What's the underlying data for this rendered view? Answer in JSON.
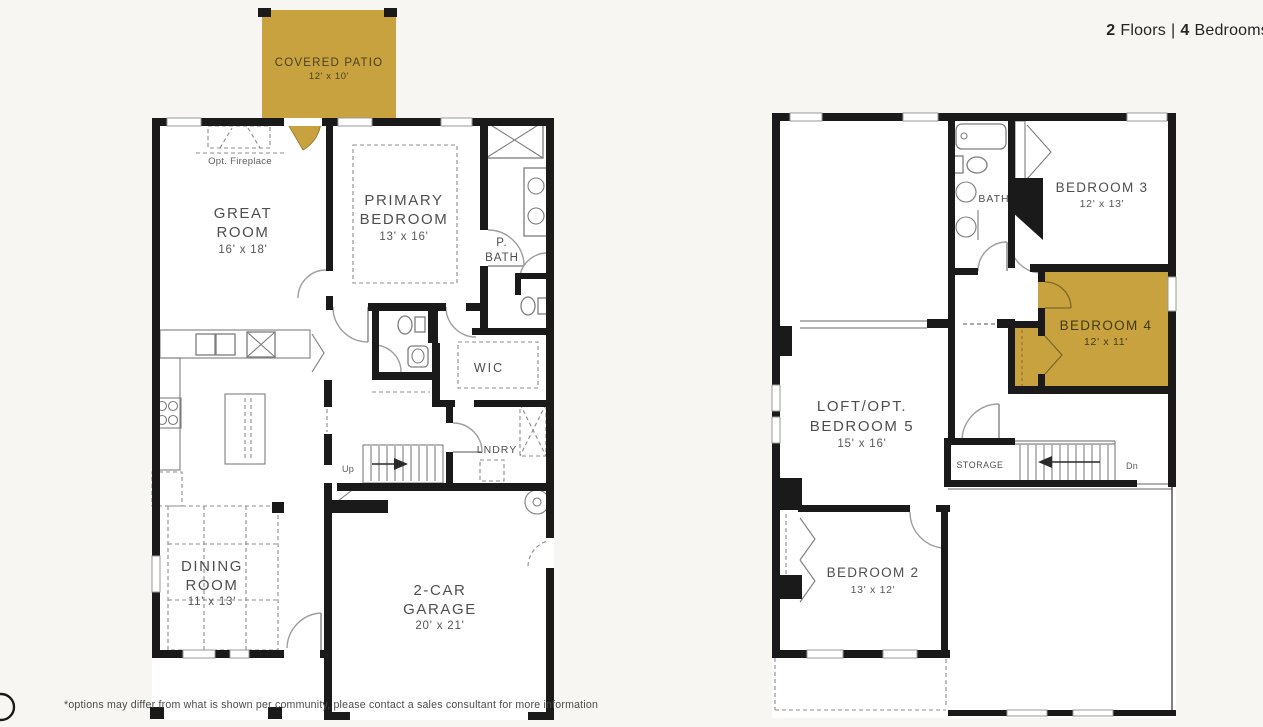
{
  "header": {
    "floors_count": "2",
    "floors_word": "Floors",
    "separator": "|",
    "bedrooms_count": "4",
    "bedrooms_word": "Bedrooms"
  },
  "floor1": {
    "covered_patio": {
      "name": "COVERED PATIO",
      "dims": "12' x 10'"
    },
    "opt_fireplace": "Opt. Fireplace",
    "great_room": {
      "line1": "GREAT",
      "line2": "ROOM",
      "dims": "16' x 18'"
    },
    "primary_bedroom": {
      "line1": "PRIMARY",
      "line2": "BEDROOM",
      "dims": "13' x 16'"
    },
    "primary_bath": {
      "line1": "P.",
      "line2": "BATH"
    },
    "closet": "WIC",
    "laundry": "LNDRY",
    "stairs": "Up",
    "dining_room": {
      "line1": "DINING",
      "line2": "ROOM",
      "dims": "11' x 13'"
    },
    "garage": {
      "line1": "2-CAR",
      "line2": "GARAGE",
      "dims": "20' x 21'"
    }
  },
  "floor2": {
    "bath": "BATH",
    "bedroom3": {
      "name": "BEDROOM 3",
      "dims": "12' x 13'"
    },
    "bedroom4": {
      "name": "BEDROOM 4",
      "dims": "12' x 11'"
    },
    "loft": {
      "line1": "LOFT/OPT.",
      "line2": "BEDROOM 5",
      "dims": "15' x 16'"
    },
    "storage": "STORAGE",
    "stairs": "Dn",
    "bedroom2": {
      "name": "BEDROOM 2",
      "dims": "13' x 12'"
    }
  },
  "footer": {
    "disclaimer": "*options may differ from what is shown per community, please contact a sales consultant for more information"
  },
  "colors": {
    "highlight_gold": "#C8A23E",
    "wall": "#1A1A1A",
    "background": "#F7F6F2",
    "interior": "#FFFFFF",
    "label_text": "#4F4F4F"
  }
}
